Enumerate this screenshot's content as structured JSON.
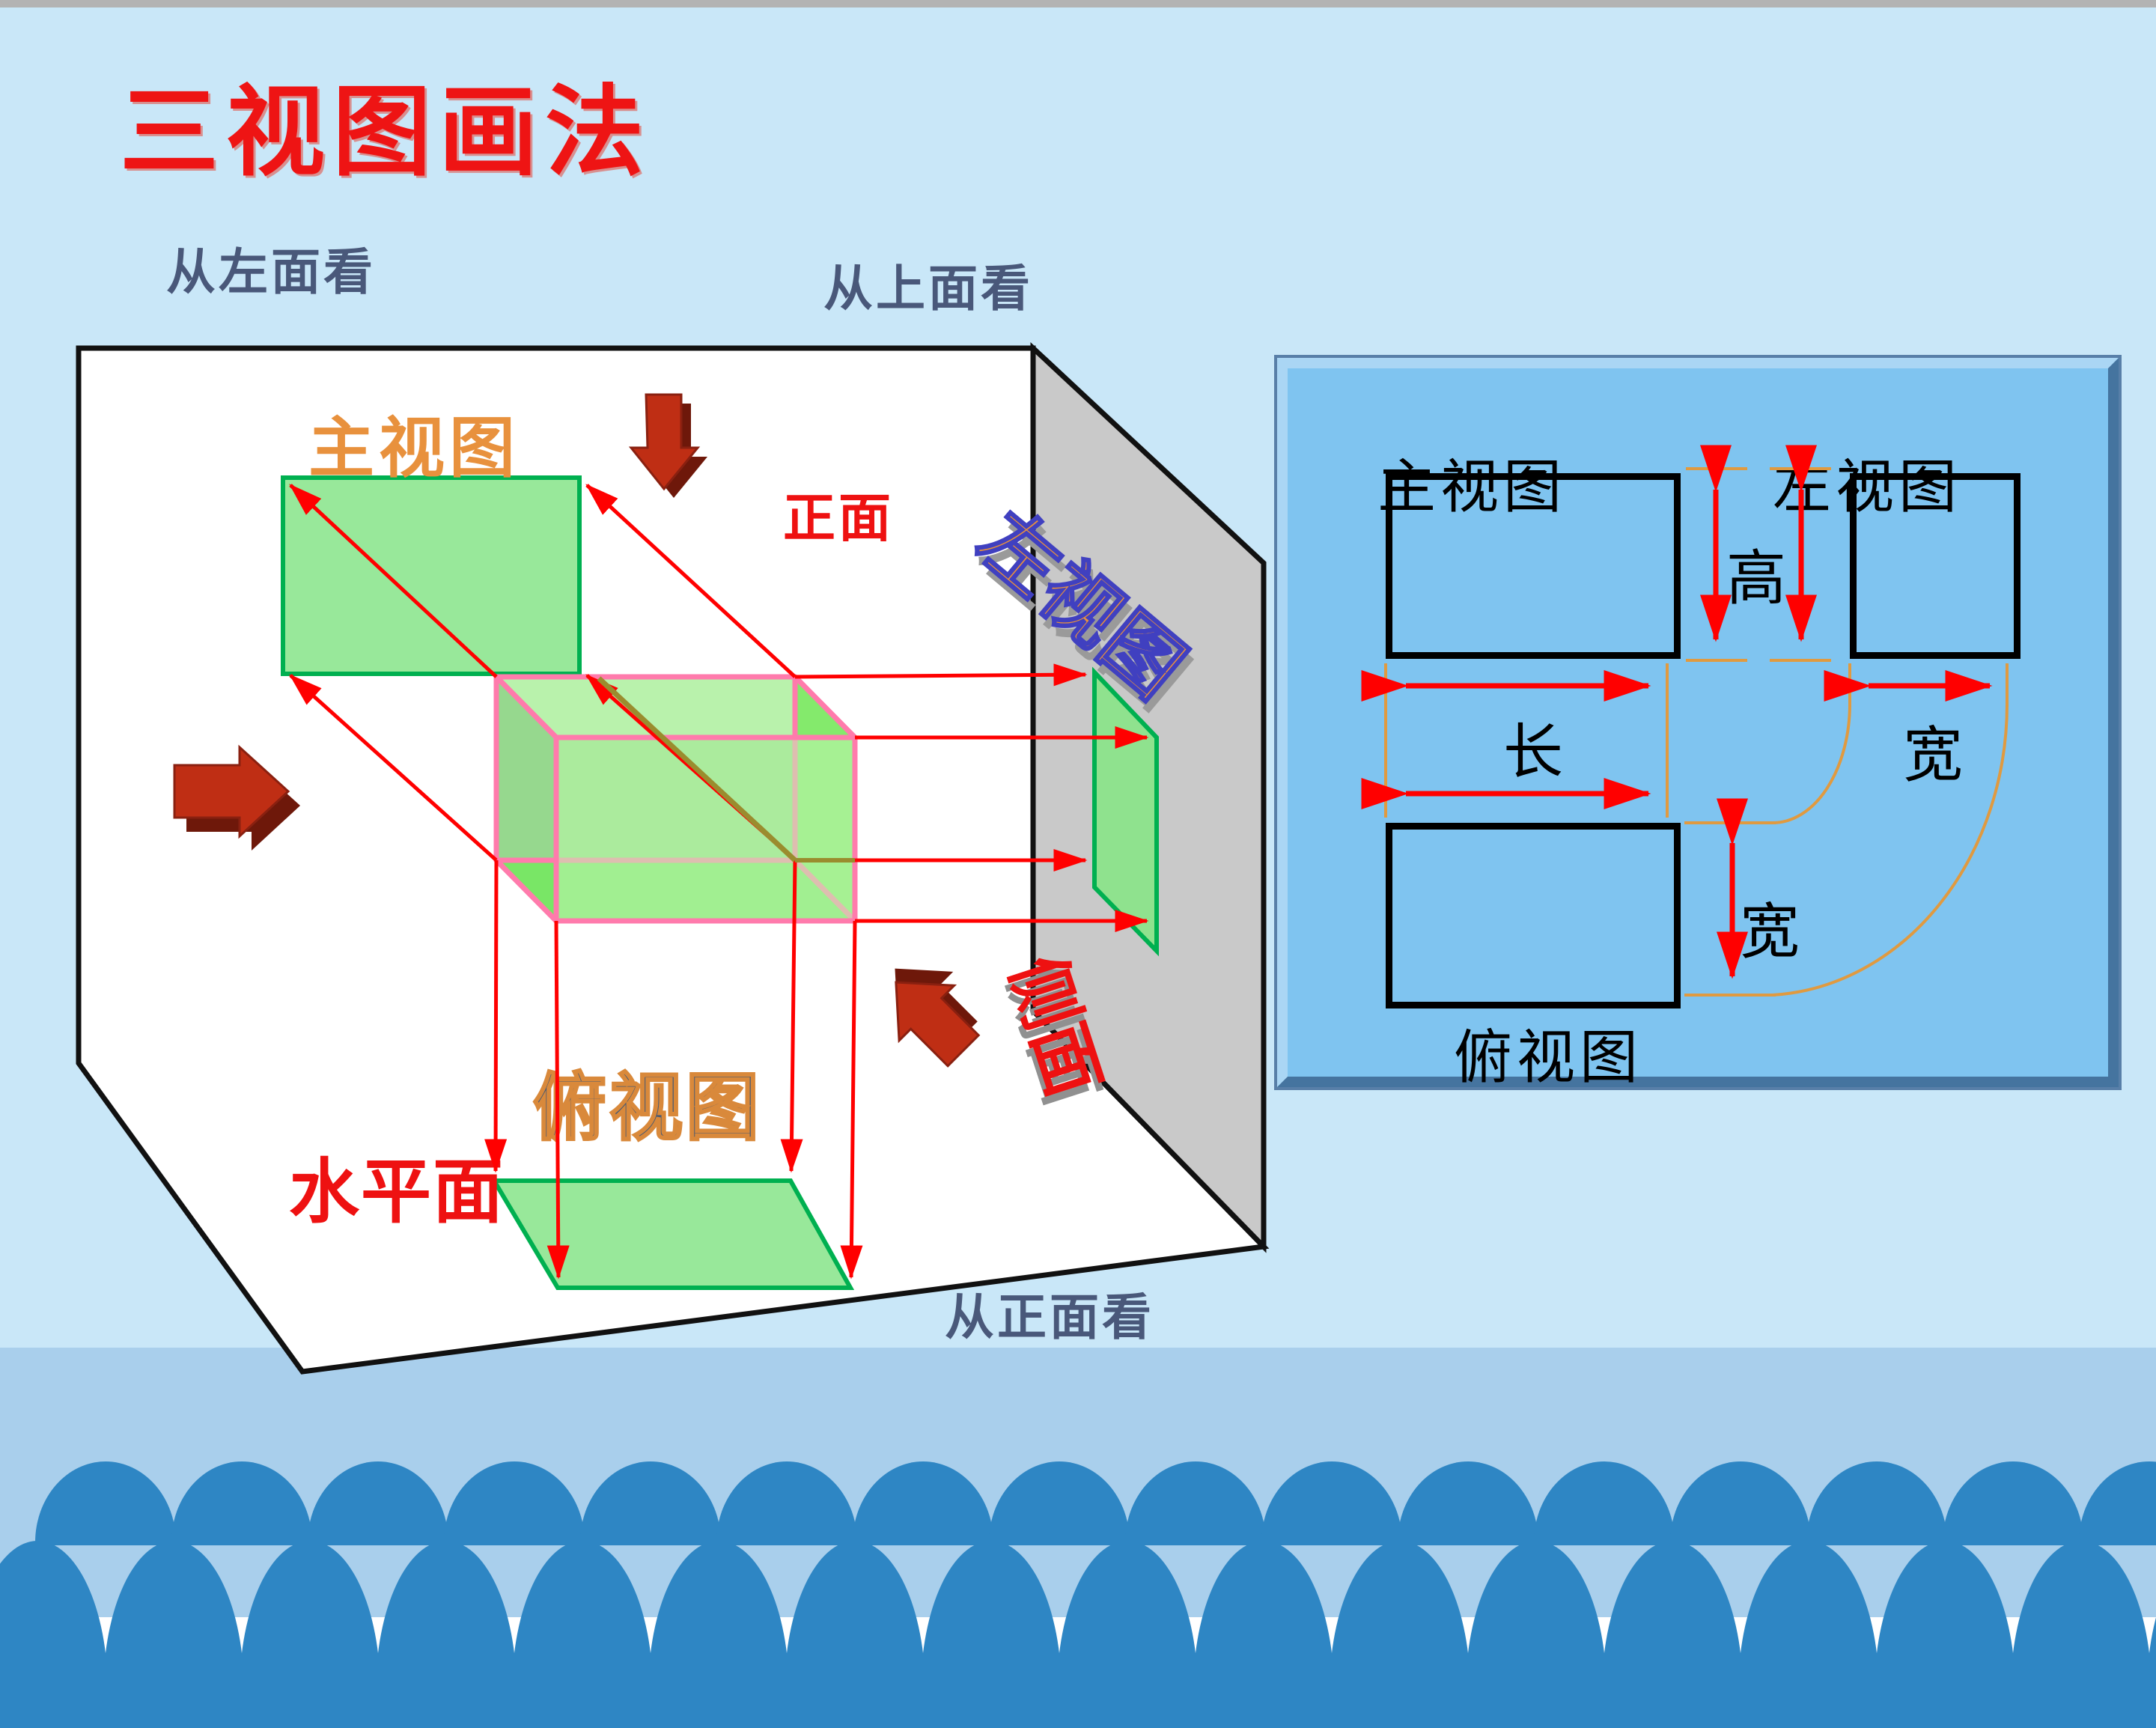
{
  "title": "三视图画法",
  "scene": {
    "view_from_left": "从左面看",
    "view_from_top": "从上面看",
    "view_from_front": "从正面看",
    "front_view_label": "主视图",
    "front_face_label": "正面",
    "left_view_label": "左视图",
    "side_face_label": "侧面",
    "horizontal_plane_label": "水平面",
    "top_view_label": "俯视图"
  },
  "panel": {
    "main_view": "主视图",
    "left_view": "左视图",
    "top_view": "俯视图",
    "height_label": "高",
    "length_label": "长",
    "width_label_side": "宽",
    "width_label_top": "宽"
  },
  "colors": {
    "background": "#c9e7f8",
    "footer_band": "#a9cfec",
    "wave_blue": "#2e86c4",
    "title_red": "#ee1414",
    "accent_red": "#ff0000",
    "label_slate": "#49587a",
    "orange_label": "#e8913d",
    "green_fill": "#98e89a",
    "green_border": "#00b050",
    "box_edge_pink": "#ff7bac",
    "gray_plane": "#c9c9c9",
    "panel_blue": "#7fc4f0",
    "dim_tick_orange": "#e09a40",
    "arrow_3d_red": "#bf2e14"
  }
}
